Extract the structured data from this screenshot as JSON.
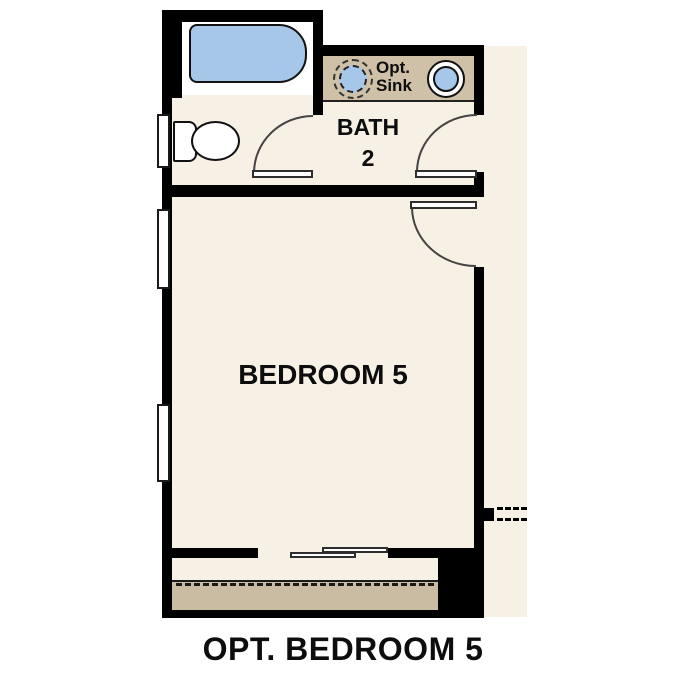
{
  "plan_title": "OPT. BEDROOM 5",
  "rooms": {
    "bedroom": {
      "label": "BEDROOM 5"
    },
    "bath": {
      "name": "BATH",
      "number": "2"
    }
  },
  "annotations": {
    "optional_sink": {
      "line1": "Opt.",
      "line2": "Sink"
    }
  },
  "colors": {
    "wall": "#000000",
    "floor": "#f7f0e4",
    "counter": "#cec1a8",
    "patio": "#c9bca2",
    "fixture": "#a7c7e8",
    "line": "#444444",
    "text": "#0d0d0d",
    "page": "#ffffff"
  }
}
